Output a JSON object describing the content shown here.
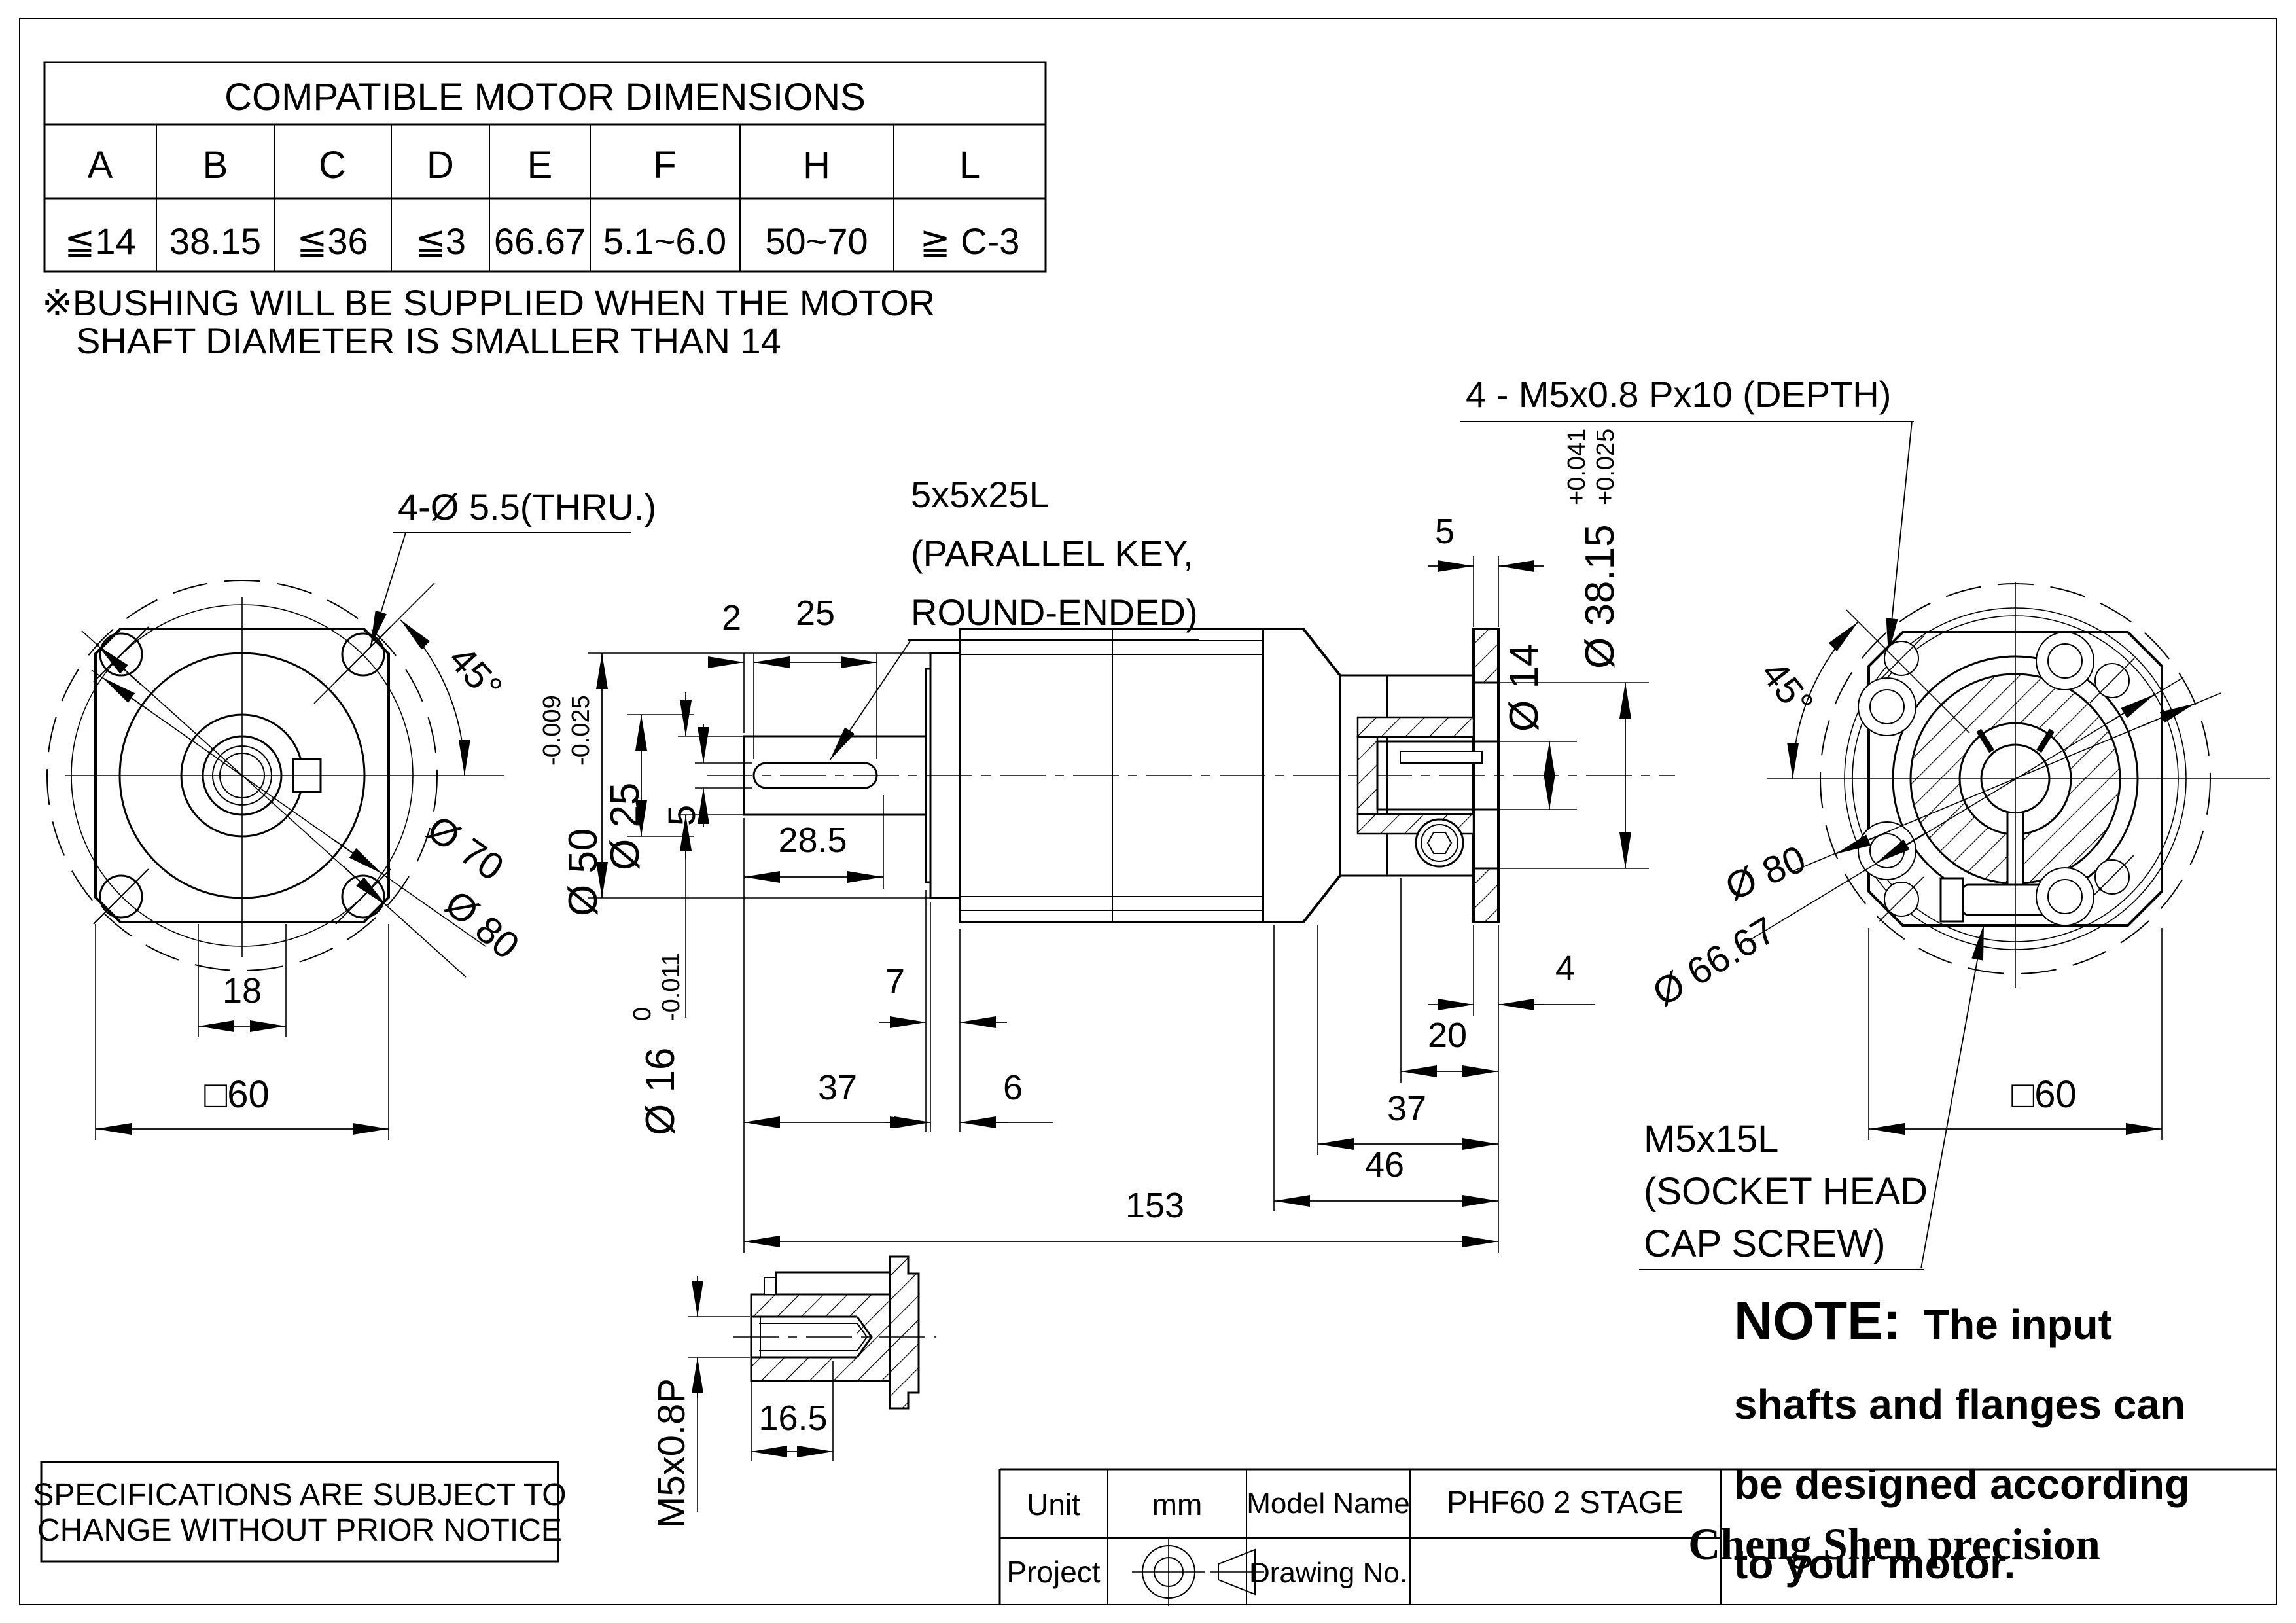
{
  "table": {
    "title": "COMPATIBLE MOTOR DIMENSIONS",
    "headers": [
      "A",
      "B",
      "C",
      "D",
      "E",
      "F",
      "H",
      "L"
    ],
    "values": [
      "≦14",
      "38.15",
      "≦36",
      "≦3",
      "66.67",
      "5.1~6.0",
      "50~70",
      "≧ C-3"
    ]
  },
  "bushing_note": {
    "line1": "※BUSHING WILL BE SUPPLIED WHEN THE MOTOR",
    "line2": "SHAFT DIAMETER IS SMALLER THAN 14"
  },
  "labels": {
    "thru_holes": "4-Ø 5.5(THRU.)",
    "angle45_left": "45°",
    "angle45_right": "45°",
    "dia70": "Ø 70",
    "dia80_left": "Ø 80",
    "dim18": "18",
    "sq60_left": "□60",
    "key_note_l1": "5x5x25L",
    "key_note_l2": "(PARALLEL KEY,",
    "key_note_l3": "ROUND-ENDED)",
    "tap_note": "4 - M5x0.8 Px10 (DEPTH)",
    "dim2": "2",
    "dim25": "25",
    "dia50": "Ø 50",
    "dia50_tol_hi": "-0.009",
    "dia50_tol_lo": "-0.025",
    "dia25": "Ø 25",
    "dim5_key": "5",
    "dim28_5": "28.5",
    "dia16": "Ø 16",
    "dia16_tol_hi": "0",
    "dia16_tol_lo": "-0.011",
    "dim7": "7",
    "dim37_left": "37",
    "dim6": "6",
    "dim5_right": "5",
    "dia14": "Ø 14",
    "dia38": "Ø 38.15",
    "dia38_tol_hi": "+0.041",
    "dia38_tol_lo": "+0.025",
    "dim4": "4",
    "dim20": "20",
    "dim37_right": "37",
    "dim46": "46",
    "dim153": "153",
    "dia80_right": "Ø 80",
    "dia66": "Ø 66.67",
    "sq60_right": "□60",
    "screw_note_l1": "M5x15L",
    "screw_note_l2": "(SOCKET HEAD",
    "screw_note_l3": "CAP SCREW)",
    "detail_thread": "M5x0.8P",
    "dim16_5": "16.5"
  },
  "note": {
    "head": "NOTE:",
    "l1": "The input",
    "l2": "shafts and flanges can",
    "l3": "be designed according",
    "l4": "to your motor."
  },
  "spec_note": {
    "line1": "SPECIFICATIONS ARE SUBJECT  TO",
    "line2": "CHANGE WITHOUT PRIOR NOTICE"
  },
  "title_block": {
    "unit_label": "Unit",
    "unit_value": "mm",
    "model_label": "Model Name",
    "model_value": "PHF60 2 STAGE",
    "project_label": "Project",
    "drawing_no_label": "Drawing No.",
    "company": "Cheng Shen precision"
  }
}
